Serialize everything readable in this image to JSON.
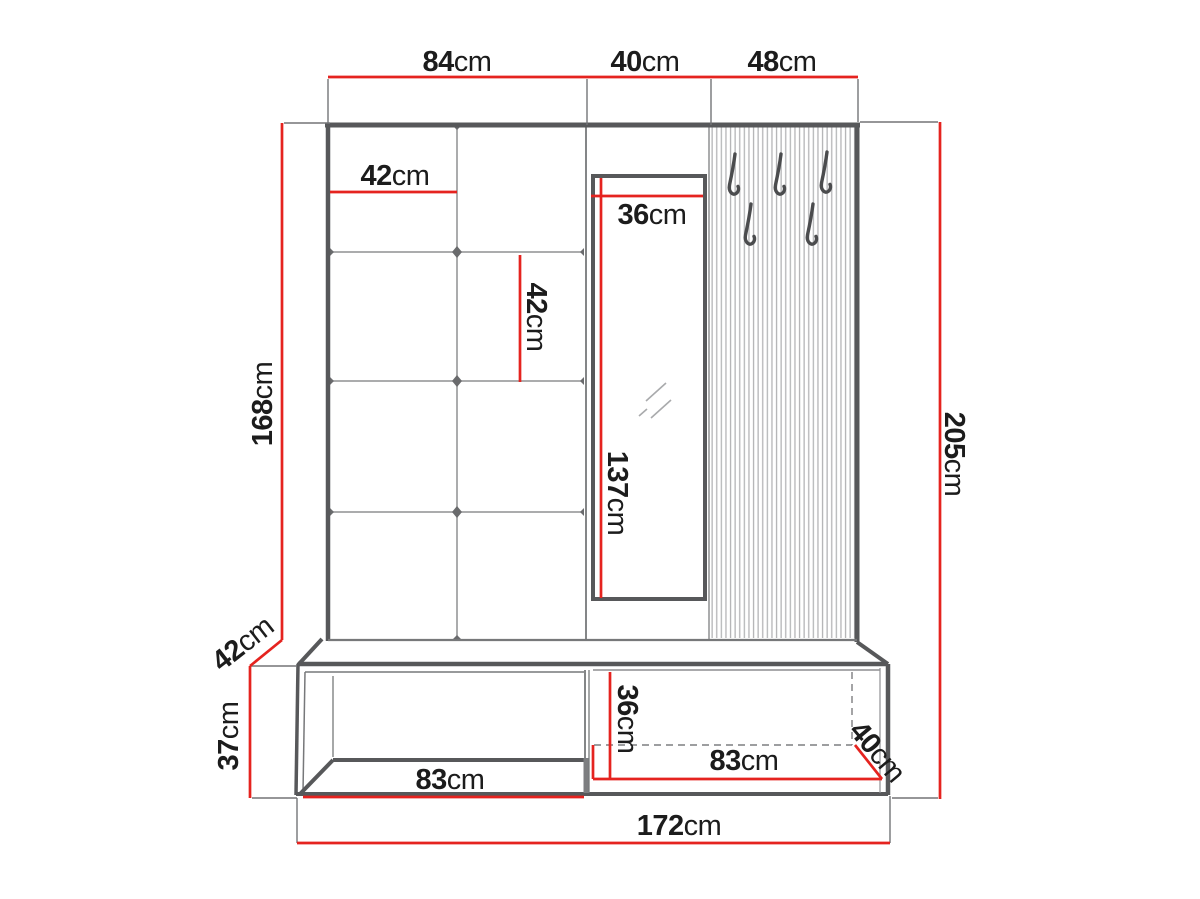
{
  "diagram": {
    "type": "furniture-dimension-drawing",
    "subject": "hallway wardrobe set: upholstered panel, mirror, slatted hook panel and shoe bench",
    "accent_color": "#e5231f",
    "outline_color": "#57585a",
    "measurements": {
      "top_section_left_width": {
        "value": "84",
        "unit": "cm"
      },
      "top_section_middle_width": {
        "value": "40",
        "unit": "cm"
      },
      "top_section_right_width": {
        "value": "48",
        "unit": "cm"
      },
      "panel_square_width": {
        "value": "42",
        "unit": "cm"
      },
      "panel_square_height": {
        "value": "42",
        "unit": "cm"
      },
      "mirror_width": {
        "value": "36",
        "unit": "cm"
      },
      "mirror_height": {
        "value": "137",
        "unit": "cm"
      },
      "panel_height": {
        "value": "168",
        "unit": "cm"
      },
      "bench_top_depth": {
        "value": "42",
        "unit": "cm"
      },
      "bench_height": {
        "value": "37",
        "unit": "cm"
      },
      "bench_niche_width": {
        "value": "83",
        "unit": "cm"
      },
      "bench_drawer_height": {
        "value": "36",
        "unit": "cm"
      },
      "bench_drawer_width": {
        "value": "83",
        "unit": "cm"
      },
      "bench_side_depth": {
        "value": "40",
        "unit": "cm"
      },
      "total_height": {
        "value": "205",
        "unit": "cm"
      },
      "total_width": {
        "value": "172",
        "unit": "cm"
      }
    }
  }
}
